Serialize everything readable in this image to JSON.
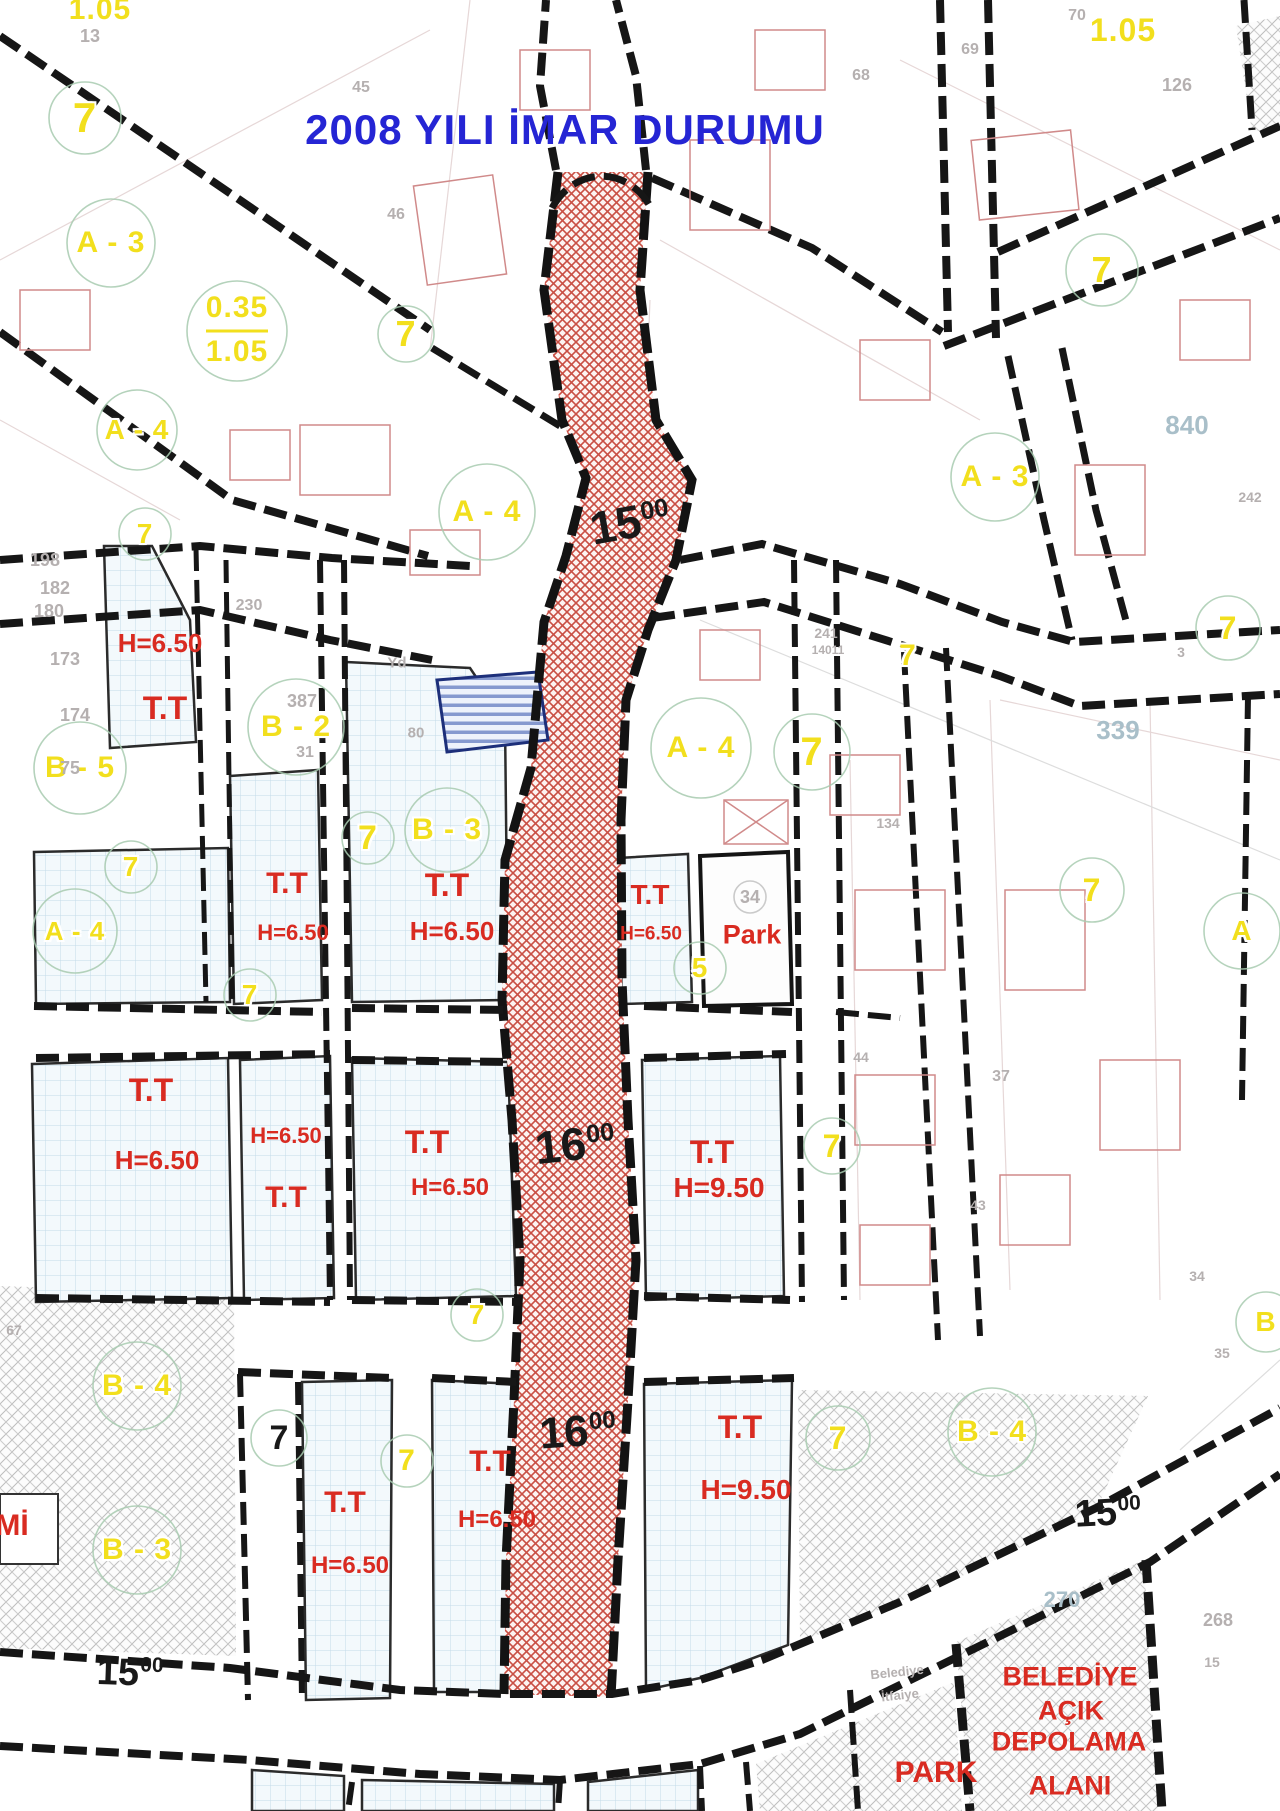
{
  "title": {
    "text": "2008 YILI İMAR DURUMU"
  },
  "colors": {
    "title_blue": "#2525d4",
    "zone_yellow": "#f2df1d",
    "plan_red": "#d92b21",
    "road_black": "#191919",
    "corridor_hatch_red": "#c94f44",
    "parcel_grid_blue": "#c3dbe9",
    "reserved_parcel_blue": "#8699cf"
  },
  "labels": [
    {
      "t": "2008 YILI İMAR DURUMU",
      "x": 565,
      "y": 130,
      "s": 42,
      "c": "t"
    },
    {
      "t": "15",
      "sup": "00",
      "x": 630,
      "y": 522,
      "s": 46,
      "c": "k",
      "r": -10
    },
    {
      "t": "16",
      "sup": "00",
      "x": 575,
      "y": 1144,
      "s": 46,
      "c": "k",
      "r": -6
    },
    {
      "t": "16",
      "sup": "00",
      "x": 578,
      "y": 1432,
      "s": 44,
      "c": "k",
      "r": -4
    },
    {
      "t": "15",
      "sup": "00",
      "x": 1108,
      "y": 1513,
      "s": 38,
      "c": "k",
      "r": -3
    },
    {
      "t": "15",
      "sup": "00",
      "x": 130,
      "y": 1673,
      "s": 38,
      "c": "k",
      "r": 2
    },
    {
      "t": "7",
      "x": 279,
      "y": 1438,
      "s": 34,
      "c": "k"
    },
    {
      "t": "1.05",
      "x": 100,
      "y": 10,
      "s": 30,
      "c": "y"
    },
    {
      "t": "7",
      "x": 85,
      "y": 118,
      "s": 42,
      "c": "y"
    },
    {
      "t": "A - 3",
      "x": 111,
      "y": 243,
      "s": 30,
      "c": "y"
    },
    {
      "t": "0.35",
      "x": 237,
      "y": 308,
      "s": 30,
      "c": "y"
    },
    {
      "t": "1.05",
      "x": 237,
      "y": 352,
      "s": 30,
      "c": "y"
    },
    {
      "t": "7",
      "x": 406,
      "y": 334,
      "s": 36,
      "c": "y"
    },
    {
      "t": "1.05",
      "x": 1123,
      "y": 30,
      "s": 32,
      "c": "y"
    },
    {
      "t": "7",
      "x": 1102,
      "y": 270,
      "s": 36,
      "c": "y"
    },
    {
      "t": "A - 4",
      "x": 137,
      "y": 430,
      "s": 28,
      "c": "y"
    },
    {
      "t": "7",
      "x": 145,
      "y": 534,
      "s": 28,
      "c": "y"
    },
    {
      "t": "A - 4",
      "x": 487,
      "y": 512,
      "s": 30,
      "c": "y"
    },
    {
      "t": "A - 3",
      "x": 995,
      "y": 477,
      "s": 30,
      "c": "y"
    },
    {
      "t": "7",
      "x": 1228,
      "y": 628,
      "s": 32,
      "c": "y"
    },
    {
      "t": "7",
      "x": 908,
      "y": 656,
      "s": 30,
      "c": "y"
    },
    {
      "t": "B - 5",
      "x": 80,
      "y": 768,
      "s": 30,
      "c": "y"
    },
    {
      "t": "B - 2",
      "x": 296,
      "y": 727,
      "s": 30,
      "c": "y"
    },
    {
      "t": "7",
      "x": 131,
      "y": 867,
      "s": 28,
      "c": "y"
    },
    {
      "t": "B - 3",
      "x": 447,
      "y": 830,
      "s": 30,
      "c": "y"
    },
    {
      "t": "7",
      "x": 368,
      "y": 838,
      "s": 34,
      "c": "y"
    },
    {
      "t": "A - 4",
      "x": 701,
      "y": 748,
      "s": 30,
      "c": "y"
    },
    {
      "t": "7",
      "x": 812,
      "y": 752,
      "s": 40,
      "c": "y"
    },
    {
      "t": "A - 4",
      "x": 75,
      "y": 931,
      "s": 26,
      "c": "y"
    },
    {
      "t": "A",
      "x": 1242,
      "y": 931,
      "s": 28,
      "c": "y"
    },
    {
      "t": "7",
      "x": 1092,
      "y": 890,
      "s": 32,
      "c": "y"
    },
    {
      "t": "5",
      "x": 700,
      "y": 968,
      "s": 28,
      "c": "y"
    },
    {
      "t": "7",
      "x": 250,
      "y": 995,
      "s": 28,
      "c": "y"
    },
    {
      "t": "7",
      "x": 832,
      "y": 1146,
      "s": 32,
      "c": "y"
    },
    {
      "t": "7",
      "x": 477,
      "y": 1315,
      "s": 28,
      "c": "y"
    },
    {
      "t": "B - 4",
      "x": 137,
      "y": 1386,
      "s": 30,
      "c": "y"
    },
    {
      "t": "7",
      "x": 407,
      "y": 1461,
      "s": 30,
      "c": "y"
    },
    {
      "t": "B - 4",
      "x": 992,
      "y": 1432,
      "s": 30,
      "c": "y"
    },
    {
      "t": "7",
      "x": 838,
      "y": 1438,
      "s": 32,
      "c": "y"
    },
    {
      "t": "B",
      "x": 1266,
      "y": 1322,
      "s": 28,
      "c": "y"
    },
    {
      "t": "B - 3",
      "x": 137,
      "y": 1550,
      "s": 30,
      "c": "y"
    },
    {
      "t": "H=6.50",
      "x": 160,
      "y": 643,
      "s": 26,
      "c": "r"
    },
    {
      "t": "T.T",
      "x": 165,
      "y": 708,
      "s": 32,
      "c": "r"
    },
    {
      "t": "T.T",
      "x": 287,
      "y": 884,
      "s": 30,
      "c": "r"
    },
    {
      "t": "H=6.50",
      "x": 293,
      "y": 933,
      "s": 22,
      "c": "r"
    },
    {
      "t": "T.T",
      "x": 447,
      "y": 885,
      "s": 32,
      "c": "r"
    },
    {
      "t": "H=6.50",
      "x": 452,
      "y": 931,
      "s": 26,
      "c": "r"
    },
    {
      "t": "T.T",
      "x": 650,
      "y": 895,
      "s": 28,
      "c": "r"
    },
    {
      "t": "H=6.50",
      "x": 651,
      "y": 934,
      "s": 19,
      "c": "r"
    },
    {
      "t": "Park",
      "x": 752,
      "y": 935,
      "s": 27,
      "c": "r"
    },
    {
      "t": "T.T",
      "x": 151,
      "y": 1090,
      "s": 32,
      "c": "r"
    },
    {
      "t": "H=6.50",
      "x": 157,
      "y": 1160,
      "s": 26,
      "c": "r"
    },
    {
      "t": "H=6.50",
      "x": 286,
      "y": 1136,
      "s": 22,
      "c": "r"
    },
    {
      "t": "T.T",
      "x": 286,
      "y": 1198,
      "s": 30,
      "c": "r"
    },
    {
      "t": "T.T",
      "x": 427,
      "y": 1142,
      "s": 32,
      "c": "r"
    },
    {
      "t": "H=6.50",
      "x": 450,
      "y": 1188,
      "s": 24,
      "c": "r"
    },
    {
      "t": "T.T",
      "x": 712,
      "y": 1152,
      "s": 32,
      "c": "r"
    },
    {
      "t": "H=9.50",
      "x": 719,
      "y": 1188,
      "s": 28,
      "c": "r"
    },
    {
      "t": "T.T",
      "x": 345,
      "y": 1503,
      "s": 30,
      "c": "r"
    },
    {
      "t": "H=6.50",
      "x": 350,
      "y": 1566,
      "s": 24,
      "c": "r"
    },
    {
      "t": "T.T",
      "x": 490,
      "y": 1462,
      "s": 30,
      "c": "r"
    },
    {
      "t": "H=6.50",
      "x": 497,
      "y": 1520,
      "s": 24,
      "c": "r"
    },
    {
      "t": "T.T",
      "x": 740,
      "y": 1427,
      "s": 32,
      "c": "r"
    },
    {
      "t": "H=9.50",
      "x": 746,
      "y": 1490,
      "s": 28,
      "c": "r"
    },
    {
      "t": "Mİ",
      "x": 12,
      "y": 1526,
      "s": 30,
      "c": "r"
    },
    {
      "t": "PARK",
      "x": 936,
      "y": 1773,
      "s": 30,
      "c": "r"
    },
    {
      "t": "BELEDİYE",
      "x": 1070,
      "y": 1677,
      "s": 27,
      "c": "r"
    },
    {
      "t": "AÇIK",
      "x": 1071,
      "y": 1711,
      "s": 27,
      "c": "r"
    },
    {
      "t": "DEPOLAMA",
      "x": 1069,
      "y": 1742,
      "s": 27,
      "c": "r"
    },
    {
      "t": "ALANI",
      "x": 1070,
      "y": 1786,
      "s": 27,
      "c": "r"
    },
    {
      "t": "13",
      "x": 90,
      "y": 36,
      "s": 18,
      "c": "g"
    },
    {
      "t": "45",
      "x": 361,
      "y": 88,
      "s": 16,
      "c": "g"
    },
    {
      "t": "46",
      "x": 396,
      "y": 215,
      "s": 16,
      "c": "g"
    },
    {
      "t": "68",
      "x": 861,
      "y": 76,
      "s": 16,
      "c": "g"
    },
    {
      "t": "69",
      "x": 970,
      "y": 50,
      "s": 16,
      "c": "g"
    },
    {
      "t": "70",
      "x": 1077,
      "y": 16,
      "s": 16,
      "c": "g"
    },
    {
      "t": "126",
      "x": 1177,
      "y": 85,
      "s": 18,
      "c": "g"
    },
    {
      "t": "198",
      "x": 45,
      "y": 560,
      "s": 18,
      "c": "g"
    },
    {
      "t": "182",
      "x": 55,
      "y": 588,
      "s": 18,
      "c": "g"
    },
    {
      "t": "180",
      "x": 49,
      "y": 611,
      "s": 18,
      "c": "g"
    },
    {
      "t": "173",
      "x": 65,
      "y": 659,
      "s": 18,
      "c": "g"
    },
    {
      "t": "174",
      "x": 75,
      "y": 715,
      "s": 18,
      "c": "g"
    },
    {
      "t": "75",
      "x": 70,
      "y": 768,
      "s": 18,
      "c": "g"
    },
    {
      "t": "230",
      "x": 249,
      "y": 606,
      "s": 16,
      "c": "g"
    },
    {
      "t": "387",
      "x": 302,
      "y": 701,
      "s": 18,
      "c": "g"
    },
    {
      "t": "31",
      "x": 305,
      "y": 753,
      "s": 16,
      "c": "g"
    },
    {
      "t": "80",
      "x": 416,
      "y": 733,
      "s": 15,
      "c": "g"
    },
    {
      "t": "Yd",
      "x": 397,
      "y": 663,
      "s": 15,
      "c": "g"
    },
    {
      "t": "241",
      "x": 826,
      "y": 633,
      "s": 14,
      "c": "g"
    },
    {
      "t": "14011",
      "x": 828,
      "y": 650,
      "s": 12,
      "c": "g"
    },
    {
      "t": "34",
      "x": 750,
      "y": 897,
      "s": 18,
      "c": "g"
    },
    {
      "t": "134",
      "x": 888,
      "y": 823,
      "s": 14,
      "c": "g"
    },
    {
      "t": "37",
      "x": 1001,
      "y": 1077,
      "s": 16,
      "c": "g"
    },
    {
      "t": "44",
      "x": 861,
      "y": 1057,
      "s": 14,
      "c": "g"
    },
    {
      "t": "43",
      "x": 978,
      "y": 1205,
      "s": 14,
      "c": "g"
    },
    {
      "t": "34",
      "x": 1197,
      "y": 1276,
      "s": 14,
      "c": "g"
    },
    {
      "t": "35",
      "x": 1222,
      "y": 1353,
      "s": 14,
      "c": "g"
    },
    {
      "t": "67",
      "x": 14,
      "y": 1330,
      "s": 14,
      "c": "g"
    },
    {
      "t": "3",
      "x": 1181,
      "y": 652,
      "s": 14,
      "c": "g"
    },
    {
      "t": "242",
      "x": 1250,
      "y": 497,
      "s": 14,
      "c": "g"
    },
    {
      "t": "268",
      "x": 1218,
      "y": 1620,
      "s": 18,
      "c": "g"
    },
    {
      "t": "15",
      "x": 1212,
      "y": 1662,
      "s": 14,
      "c": "g"
    },
    {
      "t": "Belediye",
      "x": 897,
      "y": 1672,
      "s": 13,
      "c": "g",
      "r": -6
    },
    {
      "t": "İtfaiye",
      "x": 900,
      "y": 1695,
      "s": 13,
      "c": "g",
      "r": -6
    },
    {
      "t": "840",
      "x": 1187,
      "y": 425,
      "s": 26,
      "c": "tl"
    },
    {
      "t": "339",
      "x": 1118,
      "y": 730,
      "s": 26,
      "c": "tl"
    },
    {
      "t": "270",
      "x": 1062,
      "y": 1600,
      "s": 22,
      "c": "tl"
    }
  ]
}
